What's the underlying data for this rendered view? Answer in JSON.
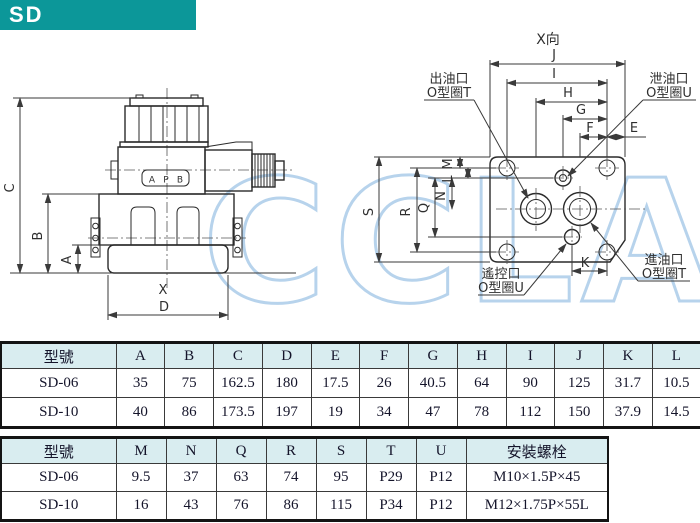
{
  "banner": {
    "title": "SD"
  },
  "watermark": "CCLAIR",
  "colors": {
    "banner_teal": "#0c9799",
    "table_header_bg": "#d9edf0",
    "watermark_blue": "#b7d3ec",
    "drawing_line": "#3a3a3a"
  },
  "left_view": {
    "dims": {
      "C": "C",
      "B": "B",
      "A": "A",
      "X": "X",
      "D": "D"
    },
    "port_letters": [
      "A",
      "P",
      "B"
    ]
  },
  "right_view": {
    "view_label": "X向",
    "dims": {
      "J": "J",
      "I": "I",
      "H": "H",
      "G": "G",
      "F": "F",
      "E": "E",
      "S": "S",
      "R": "R",
      "Q": "Q",
      "N": "N",
      "M": "M",
      "L": "L",
      "K": "K"
    },
    "callouts": {
      "outlet": {
        "line1": "出油口",
        "line2": "O型圈T"
      },
      "drain": {
        "line1": "泄油口",
        "line2": "O型圈U"
      },
      "remote": {
        "line1": "遙控口",
        "line2": "O型圈U"
      },
      "inlet": {
        "line1": "進油口",
        "line2": "O型圈T"
      }
    }
  },
  "table1": {
    "headers": [
      "型號",
      "A",
      "B",
      "C",
      "D",
      "E",
      "F",
      "G",
      "H",
      "I",
      "J",
      "K",
      "L"
    ],
    "rows": [
      [
        "SD-06",
        "35",
        "75",
        "162.5",
        "180",
        "17.5",
        "26",
        "40.5",
        "64",
        "90",
        "125",
        "31.7",
        "10.5"
      ],
      [
        "SD-10",
        "40",
        "86",
        "173.5",
        "197",
        "19",
        "34",
        "47",
        "78",
        "112",
        "150",
        "37.9",
        "14.5"
      ]
    ]
  },
  "table2": {
    "headers": [
      "型號",
      "M",
      "N",
      "Q",
      "R",
      "S",
      "T",
      "U",
      "安裝螺栓"
    ],
    "rows": [
      [
        "SD-06",
        "9.5",
        "37",
        "63",
        "74",
        "95",
        "P29",
        "P12",
        "M10×1.5P×45"
      ],
      [
        "SD-10",
        "16",
        "43",
        "76",
        "86",
        "115",
        "P34",
        "P12",
        "M12×1.75P×55L"
      ]
    ]
  }
}
